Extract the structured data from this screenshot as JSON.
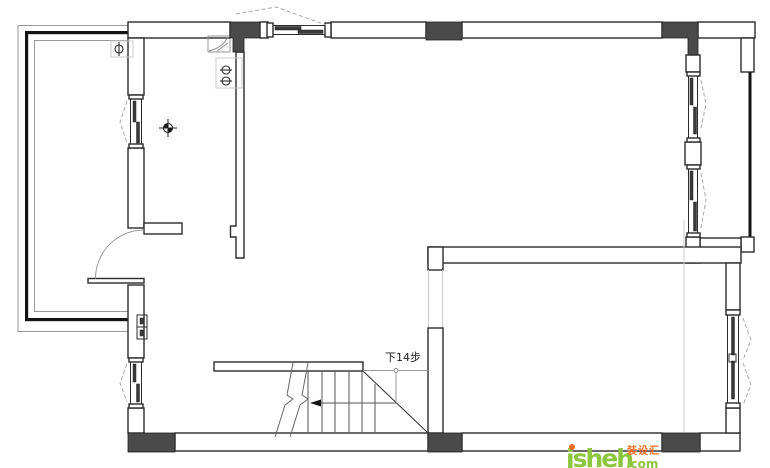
{
  "plan": {
    "stair_label": "下14步",
    "colors": {
      "wall_line": "#2b2b2b",
      "column_fill": "#4a4a4a",
      "glass_line": "#141414",
      "faint_line": "#c9c9c9",
      "brand_green": "#8CC63F",
      "brand_orange": "#F26B21"
    }
  },
  "watermark": {
    "site_name": "jsheh",
    "site_tld": ".com",
    "site_cn": "装设汇"
  }
}
